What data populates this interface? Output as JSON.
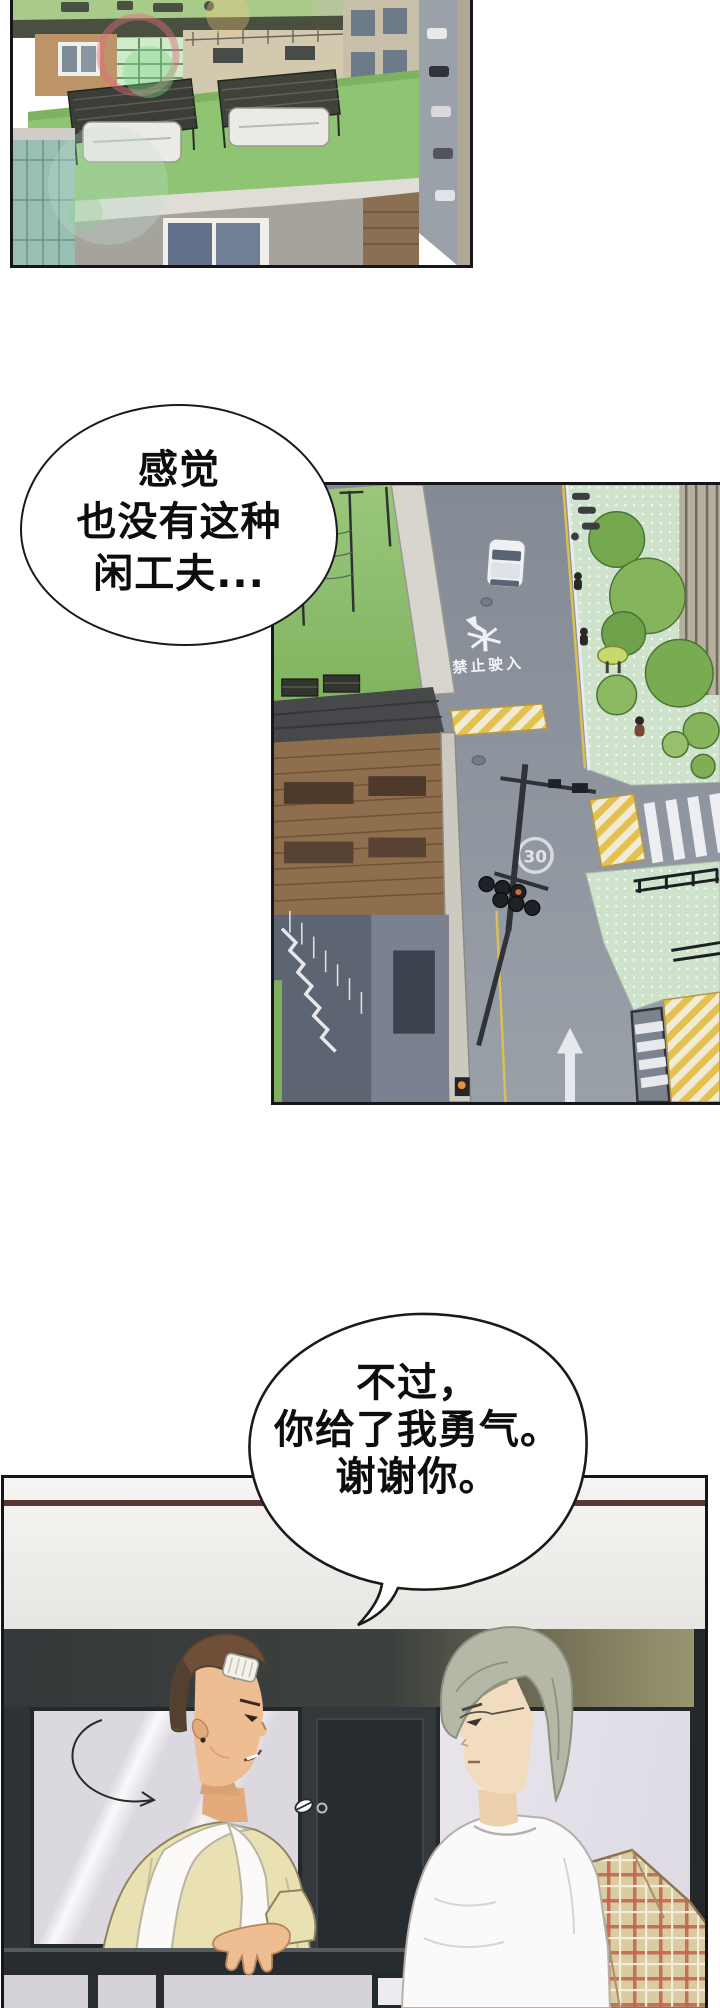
{
  "page": {
    "kind": "webtoon comic page",
    "background_color": "#ffffff"
  },
  "speech_bubbles": {
    "bubble1": {
      "lines": [
        "感觉",
        "也没有这种",
        "闲工夫..."
      ]
    },
    "bubble2": {
      "lines": [
        "不过，",
        "你给了我勇气。",
        "谢谢你。"
      ]
    }
  },
  "panels": {
    "rooftop": {
      "description": "aerial view of green apartment rooftops with pergola canopies, tables, brick buildings and lens flare"
    },
    "street": {
      "description": "high-angle dusk view of a street intersection with trees, crosswalks, traffic signals and road markings",
      "road_text": "禁止驶入",
      "speed_limit_marking": "30"
    },
    "balcony": {
      "description": "two men talking by a balcony railing; left man has short brown hair and a bandage on his temple, right man has ash-grey hair and a plaid jacket draped over his arm"
    }
  },
  "palette": {
    "panel_border": "#15151a",
    "roof_green": "#8fc472",
    "road_grey": "#8e949d",
    "sidewalk_mint": "#cfe2cc",
    "stripe_yellow": "#e3c14e",
    "wall_teal_dark": "#34383a",
    "beam_brown": "#5a3732",
    "cardigan_khaki": "#e9e0b4",
    "hair_brown": "#6f4f38",
    "hair_ash": "#b5b8a6",
    "skin_tan": "#eebd92",
    "skin_pale": "#f2dcc0",
    "plaid_tan": "#d9cba2",
    "plaid_red": "#c4604a"
  }
}
